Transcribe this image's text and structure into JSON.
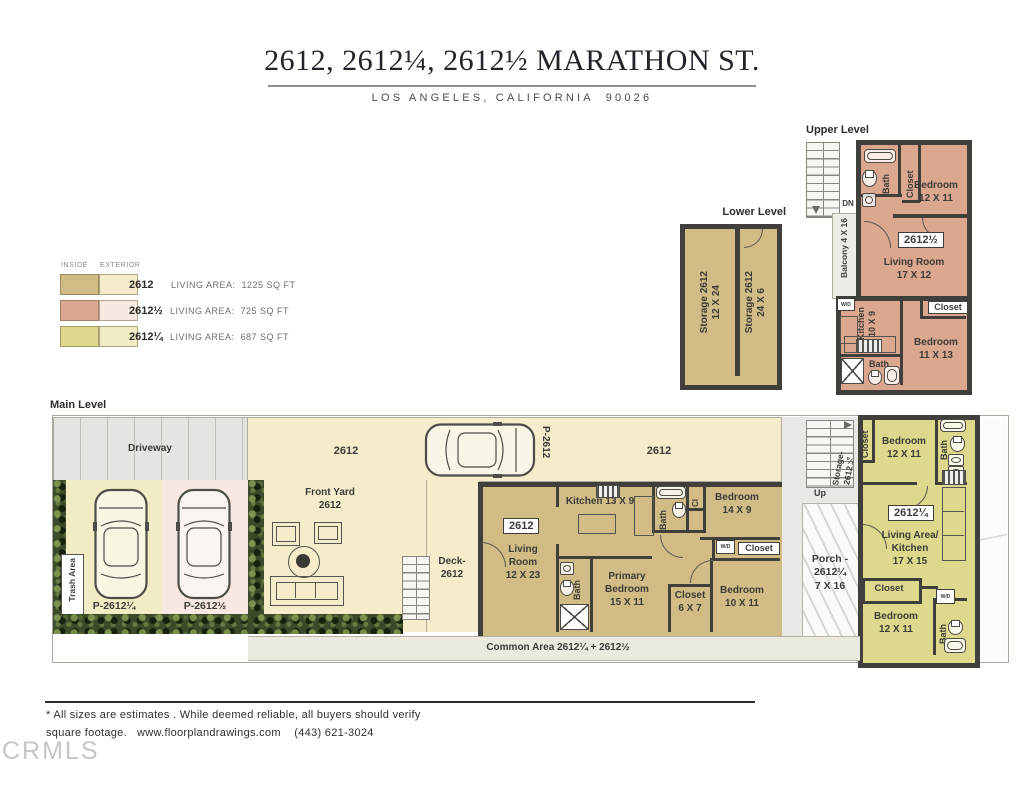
{
  "header": {
    "title": "2612, 2612¼, 2612½ MARATHON ST.",
    "subtitle": "LOS ANGELES, CALIFORNIA  90026"
  },
  "legend": {
    "inside": "INSIDE",
    "exterior": "EXTERIOR",
    "rows": [
      {
        "unit": "2612",
        "area": "LIVING AREA:  1225 SQ FT"
      },
      {
        "unit": "2612½",
        "area": "LIVING AREA:  725 SQ FT"
      },
      {
        "unit": "2612¼",
        "area": "LIVING AREA:  687 SQ FT"
      }
    ]
  },
  "colors": {
    "inside_2612": "#d2bc85",
    "exterior_2612": "#f4ecca",
    "inside_2612_half": "#dca78f",
    "exterior_2612_half": "#f7e8e1",
    "inside_2612_quarter": "#ddd88b",
    "exterior_2612_quarter": "#f1ecc4",
    "wall": "#413f3b"
  },
  "shared": {
    "wd": "W/D",
    "bath": "Bath",
    "closet": "Closet",
    "bedroom": "Bedroom"
  },
  "upper": {
    "title": "Upper Level",
    "dn": "DN",
    "balcony": "Balcony 4 X 16",
    "bedroom_top_dim": "12 X 11",
    "badge": "2612½",
    "living": "Living Room",
    "living_dim": "17 X 12",
    "kitchen": "Kitchen",
    "kitchen_dim": "10 X 9",
    "bedroom_bottom_dim": "11 X 13"
  },
  "lower": {
    "title": "Lower Level",
    "storage1": "Storage 2612",
    "storage1_dim": "12 X 24",
    "storage2": "Storage 2612",
    "storage2_dim": "24 X 6"
  },
  "main": {
    "title": "Main Level",
    "driveway": "Driveway",
    "trash": "Trash Area",
    "p_quarter": "P-2612¼",
    "p_half": "P-2612½",
    "p_main": "P-2612",
    "lot_a": "2612",
    "lot_b": "2612",
    "front_yard": "Front Yard",
    "front_yard_num": "2612",
    "deck": "Deck-",
    "deck_num": "2612",
    "badge": "2612",
    "living1": "Living",
    "living2": "Room",
    "living_dim": "12 X 23",
    "kitchen": "Kitchen 13 X 9",
    "cl": "Cl",
    "bedroom1_dim": "14 X 9",
    "primary1": "Primary",
    "primary2": "Bedroom",
    "primary_dim": "15 X 11",
    "closet2_dim": "6 X 7",
    "bedroom2_dim": "10 X 11",
    "up": "Up",
    "storage_side1": "Storage-",
    "storage_side2": "2612¼",
    "porch1": "Porch -",
    "porch2": "2612¼",
    "porch3": "7 X 16",
    "common": "Common Area 2612¼ + 2612½"
  },
  "quarter": {
    "badge": "2612¼",
    "bedroom_top_dim": "12 X 11",
    "living1": "Living Area/",
    "living2": "Kitchen",
    "living_dim": "17 X 15",
    "bedroom_bot_dim": "12 X 11"
  },
  "footer": {
    "line1": "* All sizes are estimates . While deemed reliable, all buyers should verify",
    "line2": "square footage.   www.floorplandrawings.com    (443) 621-3024",
    "logo": "CRMLS"
  }
}
